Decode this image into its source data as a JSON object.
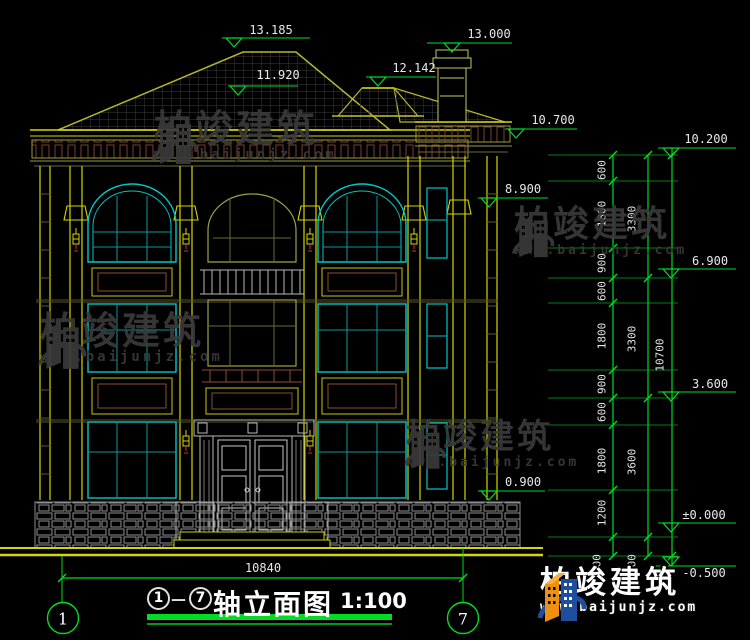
{
  "watermark": {
    "brand": "柏竣建筑",
    "url": "www.baijunjz.com"
  },
  "logo": {
    "brand": "柏竣建筑",
    "url": "www.baijunjz.com"
  },
  "footer": {
    "axis_start": "1",
    "axis_end": "7",
    "title": "轴立面图",
    "scale": "1:100",
    "overall_width": "10840"
  },
  "axis_bubbles": {
    "left": "1",
    "right": "7"
  },
  "elevations": {
    "roof": [
      "13.185",
      "13.000",
      "12.142",
      "11.920"
    ],
    "left": [
      "10.700",
      "8.900",
      "0.900"
    ],
    "right": [
      "10.200",
      "6.900",
      "3.600",
      "±0.000",
      "-0.500"
    ]
  },
  "dim_chains": {
    "inner": [
      "600",
      "1800",
      "900",
      "600",
      "1800",
      "900",
      "600",
      "1800",
      "1200",
      "500"
    ],
    "floors": [
      "3300",
      "3300",
      "3600",
      "500"
    ],
    "total": "10700"
  },
  "colors": {
    "dim_green": "#00dd22",
    "line_yellow": "#d6d600",
    "window_cyan": "#00c8c8",
    "text_white": "#e8e8e8",
    "watermark_gray": "#3a3a3a"
  }
}
